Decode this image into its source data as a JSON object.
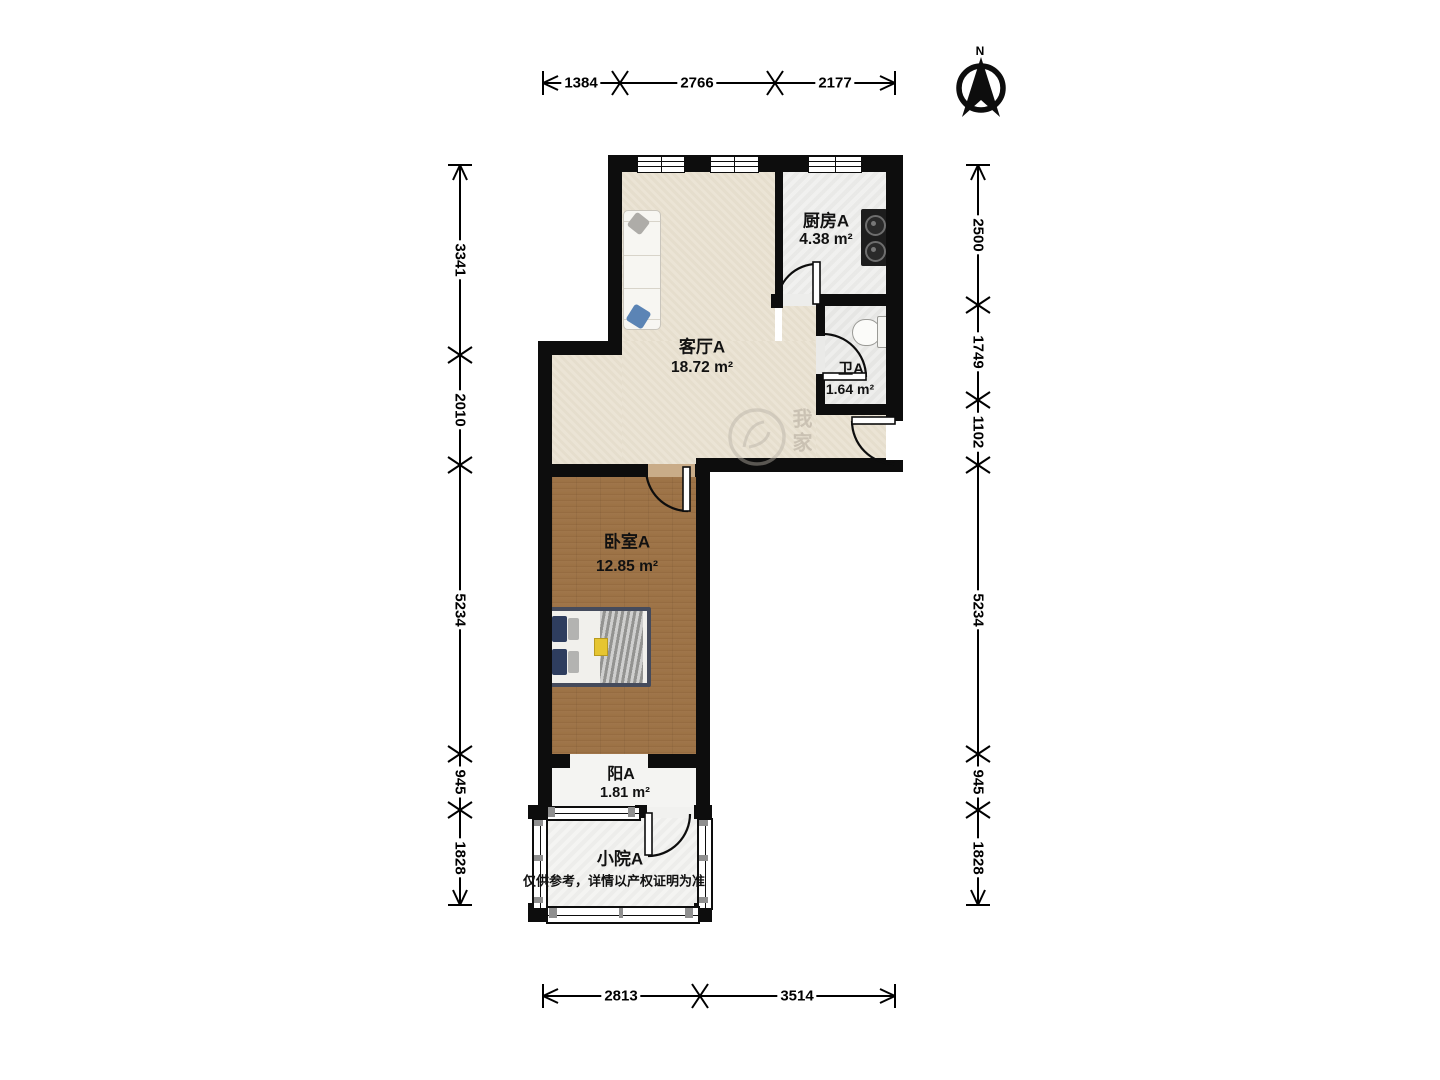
{
  "meta": {
    "type": "apartment-floor-plan",
    "north_label": "N"
  },
  "rooms": [
    {
      "id": "kitchen",
      "name": "厨房A",
      "area": "4.38 m²"
    },
    {
      "id": "living",
      "name": "客厅A",
      "area": "18.72 m²"
    },
    {
      "id": "bath",
      "name": "卫A",
      "area": "1.64 m²"
    },
    {
      "id": "bedroom",
      "name": "卧室A",
      "area": "12.85 m²"
    },
    {
      "id": "balcony",
      "name": "阳A",
      "area": "1.81 m²"
    },
    {
      "id": "courtyard",
      "name": "小院A",
      "area": ""
    }
  ],
  "disclaimer": "仅供参考，详情以产权证明为准",
  "dimensions": {
    "top": [
      "1384",
      "2766",
      "2177"
    ],
    "bottom": [
      "2813",
      "3514"
    ],
    "left": [
      "3341",
      "2010",
      "5234",
      "945",
      "1828"
    ],
    "right": [
      "2500",
      "1749",
      "1102",
      "5234",
      "945",
      "1828"
    ]
  },
  "watermark": "我家",
  "colors": {
    "wall": "#0d0d0d",
    "wood_floor": "#c8ab87",
    "living_floor": "#e9e1d0",
    "accent_pillow": "#2e3d5e"
  }
}
